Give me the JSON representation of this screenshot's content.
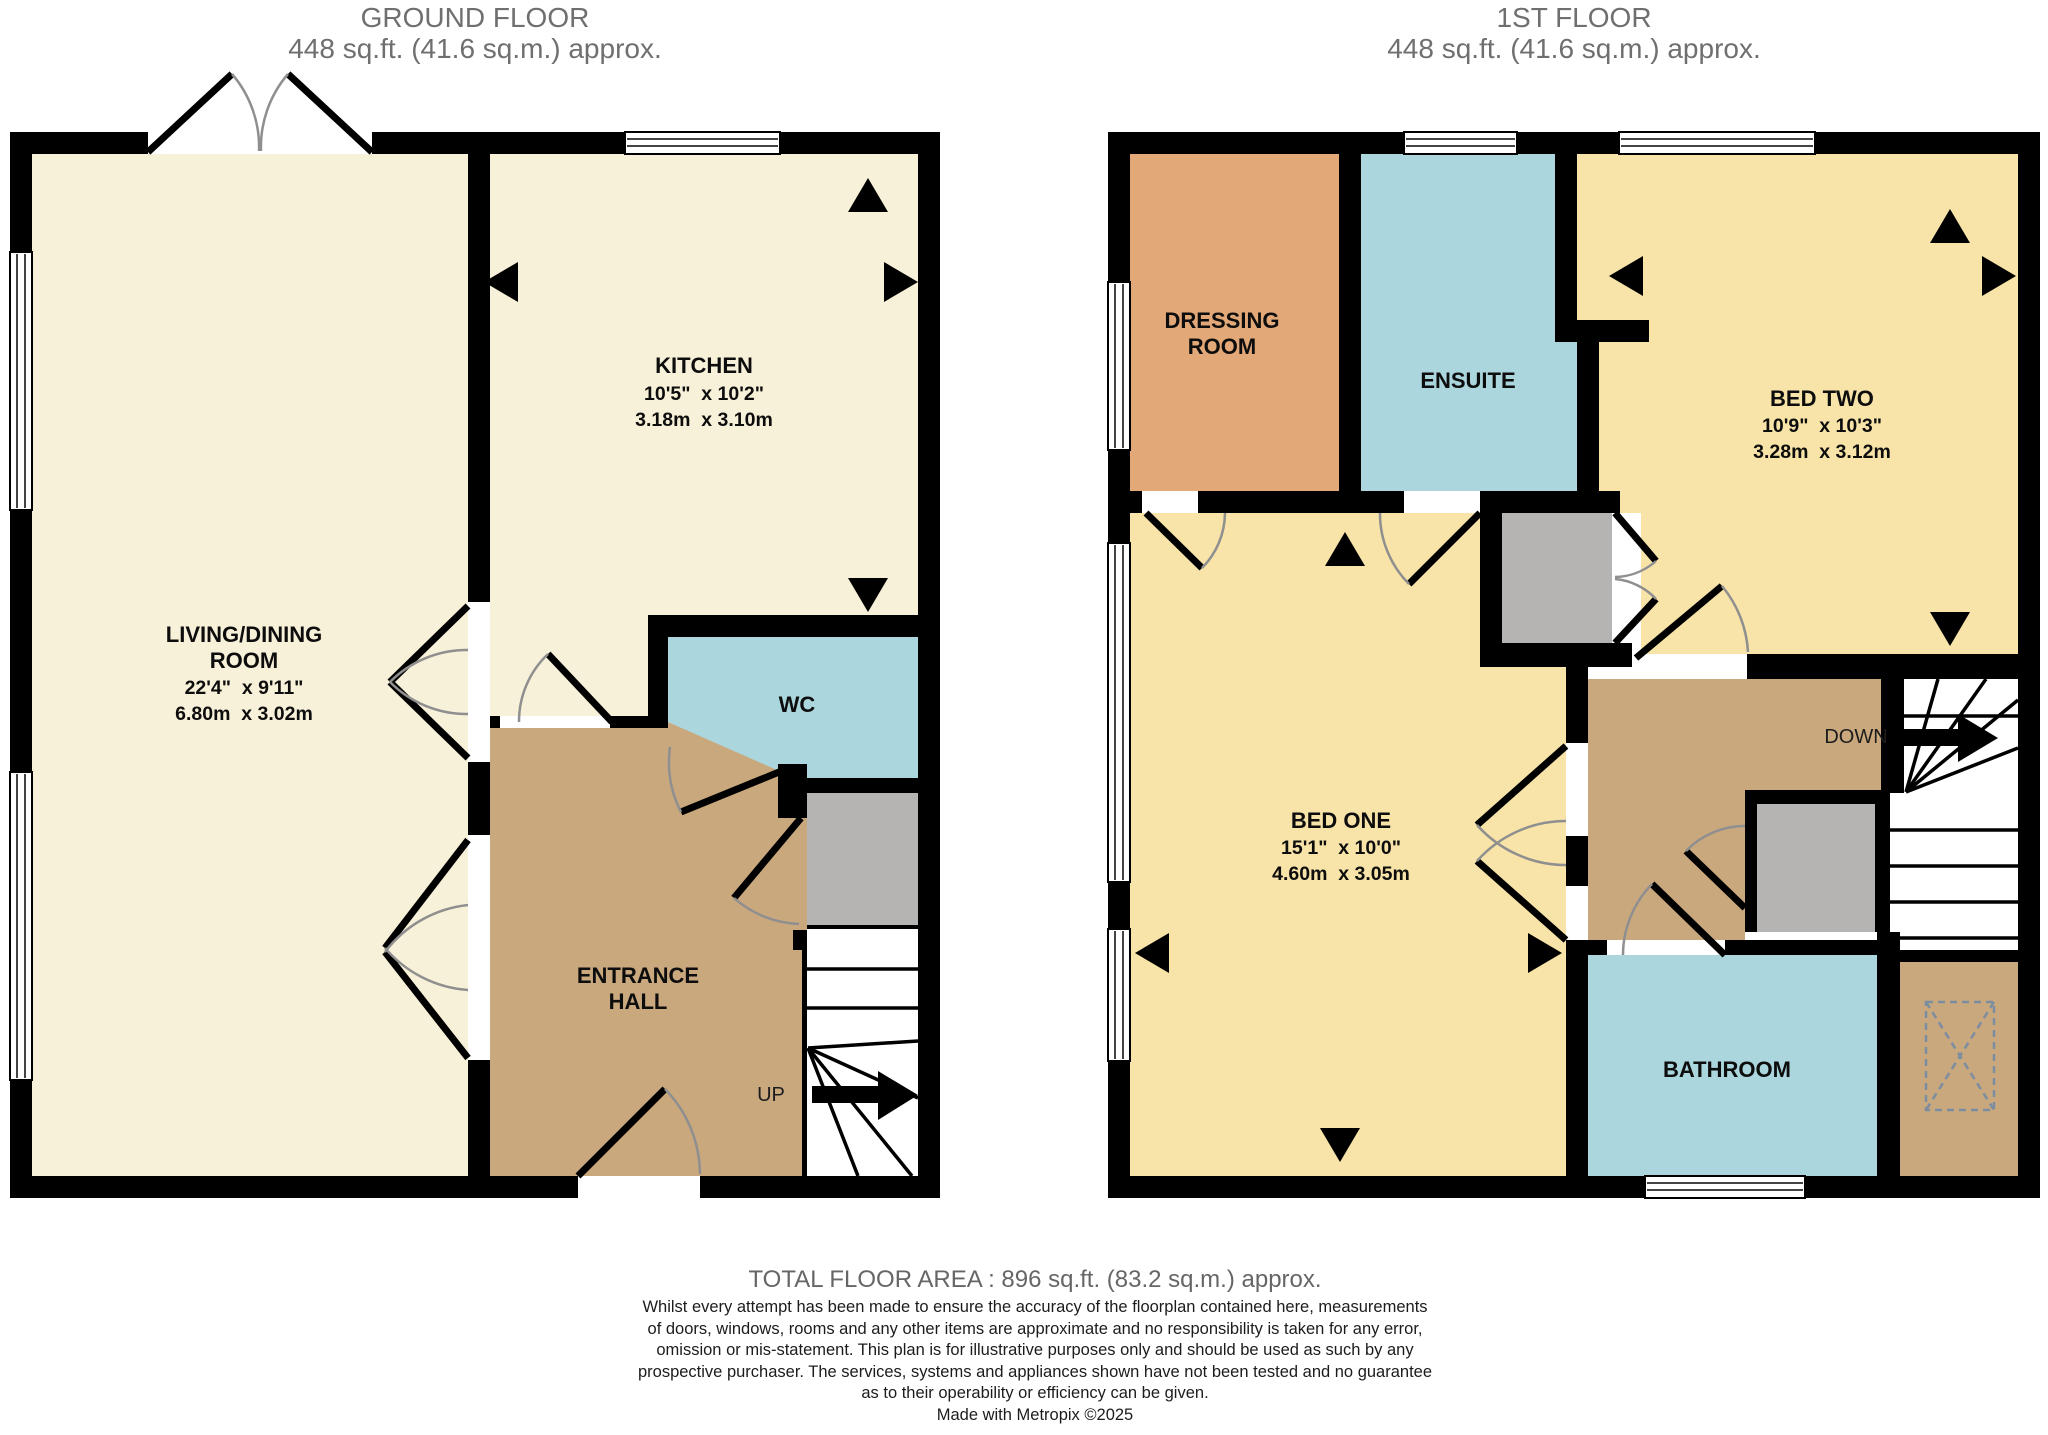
{
  "titles": {
    "ground_line1": "GROUND FLOOR",
    "ground_line2": "448 sq.ft. (41.6 sq.m.) approx.",
    "first_line1": "1ST FLOOR",
    "first_line2": "448 sq.ft. (41.6 sq.m.) approx."
  },
  "ground_floor": {
    "living_name1": "LIVING/DINING",
    "living_name2": "ROOM",
    "living_imperial": "22'4\"  x 9'11\"",
    "living_metric": "6.80m  x 3.02m",
    "kitchen_name": "KITCHEN",
    "kitchen_imperial": "10'5\"  x 10'2\"",
    "kitchen_metric": "3.18m  x 3.10m",
    "wc": "WC",
    "hall_line1": "ENTRANCE",
    "hall_line2": "HALL",
    "stairs_label": "UP"
  },
  "first_floor": {
    "dressing_line1": "DRESSING",
    "dressing_line2": "ROOM",
    "ensuite": "ENSUITE",
    "bed_two_name": "BED TWO",
    "bed_two_imperial": "10'9\"  x 10'3\"",
    "bed_two_metric": "3.28m  x 3.12m",
    "bed_one_name": "BED ONE",
    "bed_one_imperial": "15'1\"  x 10'0\"",
    "bed_one_metric": "4.60m  x 3.05m",
    "bathroom": "BATHROOM",
    "stairs_label": "DOWN"
  },
  "footer": {
    "total": "TOTAL FLOOR AREA : 896 sq.ft. (83.2 sq.m.) approx.",
    "disclaimer_lines": [
      "Whilst every attempt has been made to ensure the accuracy of the floorplan contained here, measurements",
      "of doors, windows, rooms and any other items are approximate and no responsibility is taken for any error,",
      "omission or mis-statement. This plan is for illustrative purposes only and should be used as such by any",
      "prospective purchaser. The services, systems and appliances shown have not been tested and no guarantee",
      "as to their operability or efficiency can be given."
    ],
    "credit": "Made with Metropix ©2025"
  },
  "palette": {
    "cream": "#f8f1d9",
    "pale_yellow": "#f8e4a8",
    "blue": "#abd6de",
    "tan": "#c9a87e",
    "orange": "#e2a878",
    "gray_cupboard": "#b5b4b2",
    "wall": "#000000",
    "title_gray": "#6f6f6f"
  }
}
